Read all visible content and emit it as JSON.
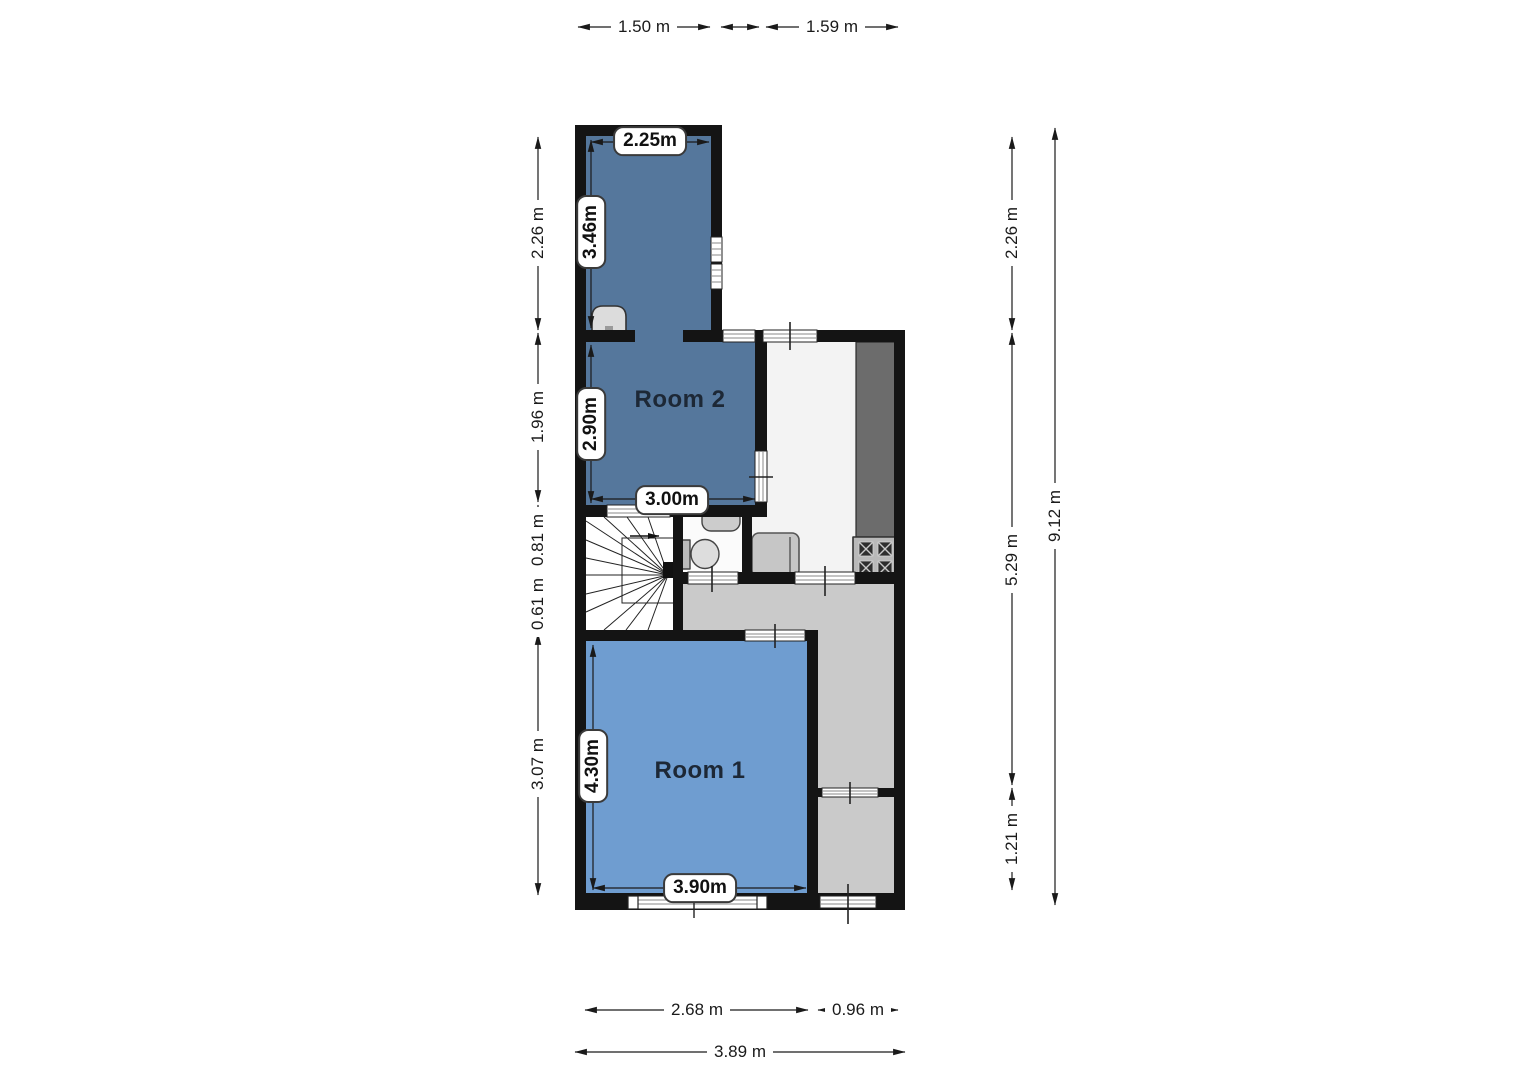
{
  "plan": {
    "type": "floor-plan",
    "rooms": [
      {
        "label": "Room 2"
      },
      {
        "label": "Room 1"
      }
    ],
    "interior_dims": [
      {
        "name": "top-room-width",
        "label": "2.25m"
      },
      {
        "name": "top-room-depth",
        "label": "3.46m"
      },
      {
        "name": "room2-depth",
        "label": "2.90m"
      },
      {
        "name": "room2-width",
        "label": "3.00m"
      },
      {
        "name": "room1-depth",
        "label": "4.30m"
      },
      {
        "name": "room1-width",
        "label": "3.90m"
      }
    ],
    "exterior_dims": {
      "top": [
        {
          "label": "1.50 m"
        },
        {
          "label": "1.59 m"
        }
      ],
      "left": [
        {
          "label": "2.26 m"
        },
        {
          "label": "1.96 m"
        },
        {
          "label": "0.81 m"
        },
        {
          "label": "0.61 m"
        },
        {
          "label": "3.07 m"
        }
      ],
      "right": [
        {
          "label": "2.26 m"
        },
        {
          "label": "5.29 m"
        },
        {
          "label": "1.21 m"
        },
        {
          "label": "9.12 m"
        }
      ],
      "bottom": [
        {
          "label": "2.68 m"
        },
        {
          "label": "0.96 m"
        },
        {
          "label": "3.89 m"
        }
      ]
    },
    "fixtures": [
      "sink",
      "wash-basin",
      "toilet",
      "armchair",
      "kitchen-counter",
      "stove",
      "winder-staircase",
      "stair-direction-arrow"
    ],
    "colors": {
      "room_dark_blue": "#55779c",
      "room_light_blue": "#6f9dd0",
      "hallway_gray": "#cacaca",
      "living_white": "#f3f3f3",
      "wall_black": "#141414",
      "counter_gray": "#6c6c6c",
      "stove_gray": "#b9b9b9",
      "dim_line": "#1a1a1a"
    }
  }
}
